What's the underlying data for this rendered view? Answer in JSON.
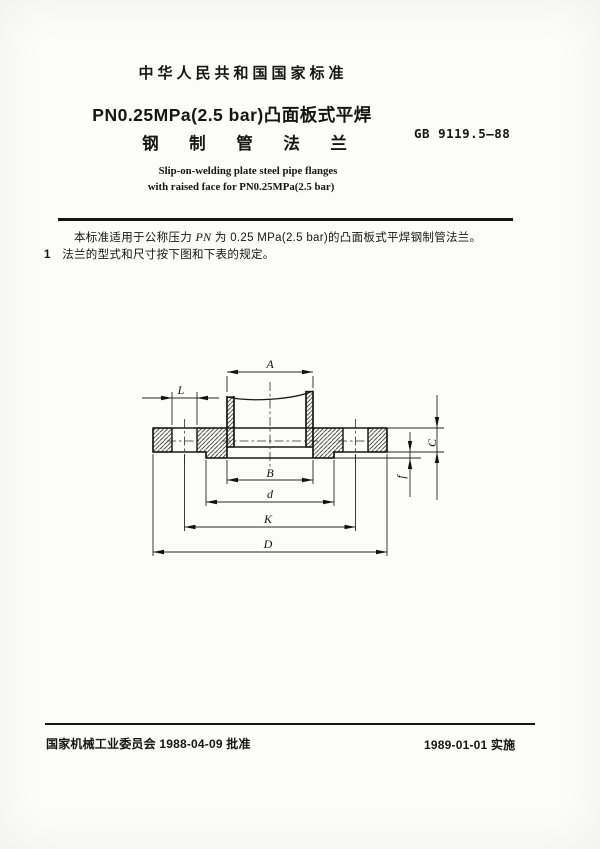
{
  "header": {
    "national_standard_label": "中华人民共和国国家标准",
    "title_line1": "PN0.25MPa(2.5 bar)凸面板式平焊",
    "title_line2": "钢 制 管 法 兰",
    "standard_number": "GB 9119.5—88",
    "subtitle_en_line1": "Slip-on-welding plate steel pipe flanges",
    "subtitle_en_line2": "with raised face for PN0.25MPa(2.5 bar)"
  },
  "body": {
    "scope_prefix": "本标准适用于公称压力 ",
    "scope_pn": "PN",
    "scope_suffix": " 为 0.25 MPa(2.5 bar)的凸面板式平焊钢制管法兰。",
    "clause1_number": "1",
    "clause1_text": "法兰的型式和尺寸按下图和下表的规定。"
  },
  "figure": {
    "type": "flange-cross-section-drawing",
    "dims": {
      "A": "A",
      "B": "B",
      "d": "d",
      "K": "K",
      "D": "D",
      "L": "L",
      "C": "C",
      "f": "f"
    }
  },
  "footer": {
    "approval": "国家机械工业委员会 1988-04-09 批准",
    "implementation": "1989-01-01 实施"
  }
}
